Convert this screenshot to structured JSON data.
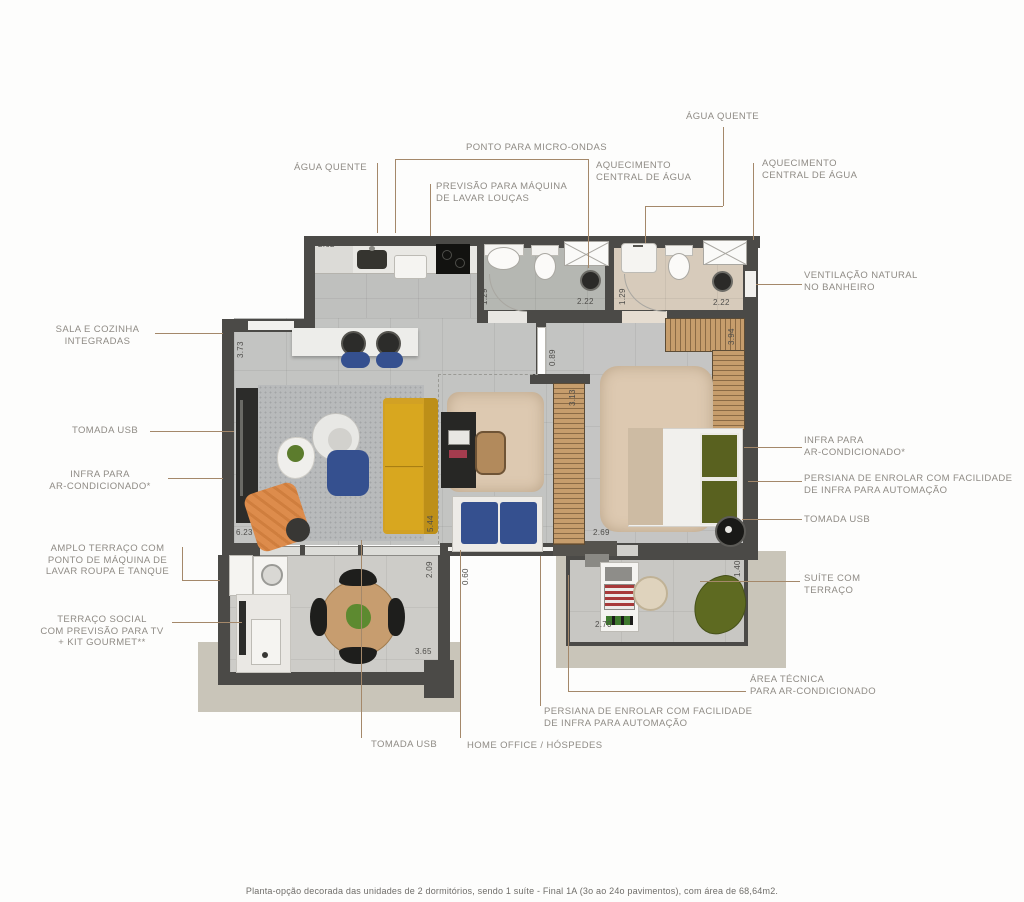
{
  "plan": {
    "caption": "Planta-opção decorada das unidades de 2 dormitórios, sendo 1 suíte - Final 1A (3o ao 24o pavimentos), com área de 68,64m2.",
    "labels": {
      "agua_quente_top": "ÁGUA QUENTE",
      "aquecimento_right": "AQUECIMENTO\nCENTRAL DE ÁGUA",
      "ponto_micro_ondas": "PONTO PARA MICRO-ONDAS",
      "agua_quente_left": "ÁGUA QUENTE",
      "previsao_lava_loucas": "PREVISÃO PARA MÁQUINA\nDE LAVAR LOUÇAS",
      "aquecimento_mid": "AQUECIMENTO\nCENTRAL DE ÁGUA",
      "ventilacao": "VENTILAÇÃO NATURAL\nNO BANHEIRO",
      "sala_cozinha": "SALA E COZINHA\nINTEGRADAS",
      "tomada_usb_left": "TOMADA USB",
      "infra_ar_left": "INFRA PARA\nAR-CONDICIONADO*",
      "amplo_terraco": "AMPLO TERRAÇO COM\nPONTO DE MÁQUINA DE\nLAVAR ROUPA E TANQUE",
      "terraco_social": "TERRAÇO SOCIAL\nCOM PREVISÃO PARA TV\n+ KIT GOURMET**",
      "infra_ar_right": "INFRA PARA\nAR-CONDICIONADO*",
      "persiana_right": "PERSIANA DE ENROLAR COM FACILIDADE\nDE INFRA PARA AUTOMAÇÃO",
      "tomada_usb_right": "TOMADA USB",
      "suite_terraco": "SUÍTE COM\nTERRAÇO",
      "area_tecnica": "ÁREA TÉCNICA\nPARA AR-CONDICIONADO",
      "persiana_bottom": "PERSIANA DE ENROLAR COM FACILIDADE\nDE INFRA PARA AUTOMAÇÃO",
      "tomada_usb_bottom": "TOMADA USB",
      "home_office": "HOME OFFICE / HÓSPEDES"
    },
    "dimensions": [
      "2.62",
      "3.73",
      "1.29",
      "2.22",
      "1.29",
      "2.22",
      "3.94",
      "0.89",
      "3.13",
      "5.44",
      "6.23",
      "2.69",
      "2.09",
      "0.60",
      "3.65",
      "2.70",
      "1.40"
    ],
    "colors": {
      "wall": "#4b4a47",
      "wood_slats": "#c69d6c",
      "sofa_yellow": "#d2a124",
      "accent_blue": "#35508f",
      "accent_orange": "#dd8c4c",
      "leader_line": "#a4886a",
      "label_text": "#8f8b85",
      "slab": "#c9c5b9"
    }
  }
}
